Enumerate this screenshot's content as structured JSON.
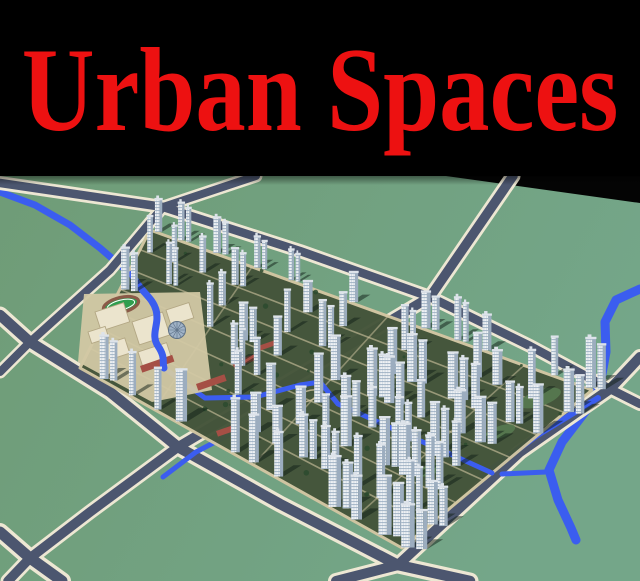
{
  "banner": {
    "title": "Urban Spaces",
    "bg": "#000000",
    "fg": "#ed1111"
  },
  "scene": {
    "alt": "Aerial 3D render of a residential master plan: white high-rise towers, diagonal roads, river and school campus on green terrain",
    "colors": {
      "ground_l": "#6f9c77",
      "ground_r": "#74a689",
      "sky": "#040404",
      "road_casing": "#ede7d3",
      "road_asphalt": "#4c566f",
      "river": "#3b5def",
      "dev_ground": "#44543a",
      "dev_path": "#d2c6a2",
      "tower_body": "#eff2f5",
      "tower_side": "#9cadbf",
      "tower_window": "#8fa4ba",
      "tower_cap": "#dde3ea",
      "shadow": "rgba(16,30,22,0.5)",
      "campus_ground": "#d2c8a4",
      "campus_block": "#ebe4cd",
      "campus_block_edge": "#b3a784",
      "roof_red": "#a54f45",
      "track_green": "#2f9e4e",
      "track_ring": "#8a5a48",
      "dome": "#9fb2c6",
      "dome_edge": "#5c7086",
      "tree": "#2c4a2e",
      "lawn": "#567a50"
    },
    "sky_wedge": [
      [
        446,
        176
      ],
      [
        640,
        176
      ],
      [
        640,
        203
      ]
    ],
    "roads": [
      {
        "pts": [
          [
            0,
            183
          ],
          [
            163,
            207
          ],
          [
            300,
            251
          ],
          [
            430,
            297
          ],
          [
            530,
            346
          ],
          [
            610,
            389
          ],
          [
            640,
            404
          ]
        ],
        "cw": 14,
        "aw": 8.5
      },
      {
        "pts": [
          [
            0,
            315
          ],
          [
            30,
            342
          ],
          [
            110,
            392
          ],
          [
            178,
            447
          ],
          [
            280,
            504
          ],
          [
            398,
            565
          ],
          [
            470,
            581
          ]
        ],
        "cw": 17,
        "aw": 10.5
      },
      {
        "pts": [
          [
            0,
            532
          ],
          [
            30,
            558
          ],
          [
            62,
            581
          ]
        ],
        "cw": 18,
        "aw": 11
      },
      {
        "pts": [
          [
            256,
            176
          ],
          [
            163,
            207
          ],
          [
            110,
            270
          ],
          [
            30,
            342
          ],
          [
            0,
            372
          ]
        ],
        "cw": 13,
        "aw": 8
      },
      {
        "pts": [
          [
            513,
            176
          ],
          [
            430,
            297
          ],
          [
            304,
            372
          ],
          [
            178,
            447
          ],
          [
            90,
            512
          ],
          [
            30,
            558
          ],
          [
            8,
            581
          ]
        ],
        "cw": 15,
        "aw": 9.5
      },
      {
        "pts": [
          [
            640,
            357
          ],
          [
            610,
            389
          ],
          [
            520,
            452
          ],
          [
            398,
            565
          ],
          [
            336,
            581
          ]
        ],
        "cw": 16,
        "aw": 10
      }
    ],
    "rivers": [
      {
        "pts": [
          [
            0,
            192
          ],
          [
            35,
            205
          ],
          [
            70,
            225
          ],
          [
            100,
            248
          ],
          [
            128,
            272
          ]
        ],
        "w": 7
      },
      {
        "pts": [
          [
            640,
            289
          ],
          [
            616,
            300
          ],
          [
            605,
            322
          ],
          [
            606,
            352
          ],
          [
            600,
            385
          ],
          [
            588,
            408
          ],
          [
            562,
            442
          ],
          [
            549,
            470
          ],
          [
            558,
            500
          ],
          [
            571,
            528
          ],
          [
            576,
            540
          ]
        ],
        "w": 9
      }
    ],
    "canals": [
      {
        "pts": [
          [
            598,
            398
          ],
          [
            536,
            436
          ],
          [
            482,
            476
          ]
        ],
        "w": 6
      },
      {
        "pts": [
          [
            502,
            474
          ],
          [
            546,
            472
          ]
        ],
        "w": 5
      },
      {
        "pts": [
          [
            238,
            430
          ],
          [
            196,
            452
          ],
          [
            163,
            477
          ]
        ],
        "w": 5
      }
    ],
    "dev_stream": {
      "pts": [
        [
          164,
          368
        ],
        [
          205,
          398
        ],
        [
          255,
          397
        ],
        [
          300,
          385
        ],
        [
          320,
          382
        ],
        [
          338,
          404
        ],
        [
          365,
          416
        ],
        [
          400,
          432
        ],
        [
          448,
          453
        ],
        [
          492,
          473
        ]
      ],
      "w": 5
    },
    "dev": {
      "n": [
        150,
        230
      ],
      "e": [
        592,
        390
      ],
      "s": [
        402,
        548
      ],
      "w": [
        80,
        368
      ],
      "campus_poly": [
        [
          82,
          292
        ],
        [
          202,
          290
        ],
        [
          214,
          392
        ],
        [
          152,
          404
        ],
        [
          74,
          362
        ]
      ],
      "spine_a": [
        424,
        303
      ],
      "spine_b": [
        186,
        441
      ],
      "rows": 8,
      "cols": 14,
      "skip_chance": 0.1,
      "pair_chance": 0.38,
      "plaza": {
        "cx": 308,
        "cy": 396,
        "rx": 12,
        "ry": 5,
        "rot": -19
      },
      "lawns": [
        [
          540,
          398,
          22,
          8,
          -19
        ],
        [
          500,
          432,
          16,
          6,
          -19
        ],
        [
          430,
          470,
          14,
          5,
          -19
        ]
      ],
      "tree_count": 46
    },
    "campus": {
      "ground": [
        [
          84,
          294
        ],
        [
          200,
          292
        ],
        [
          212,
          390
        ],
        [
          152,
          402
        ],
        [
          78,
          362
        ]
      ],
      "track": {
        "cx": 121,
        "cy": 305,
        "rx": 18,
        "ry": 7.5,
        "rot": -14
      },
      "dome": {
        "cx": 177,
        "cy": 330,
        "r": 8.5
      },
      "blocks": [
        [
          95,
          312,
          30,
          20
        ],
        [
          132,
          322,
          32,
          24
        ],
        [
          166,
          310,
          24,
          16
        ],
        [
          100,
          346,
          26,
          16
        ],
        [
          138,
          352,
          30,
          18
        ],
        [
          88,
          332,
          18,
          12
        ]
      ],
      "roofs": [
        [
          140,
          366,
          34,
          7
        ],
        [
          196,
          384,
          30,
          7
        ],
        [
          232,
          362,
          24,
          6
        ],
        [
          216,
          431,
          20,
          6
        ],
        [
          258,
          346,
          18,
          5
        ]
      ],
      "lake": "M132,274 C140,292 152,296 156,310 C160,324 150,334 158,346 C166,358 162,362 164,368"
    }
  }
}
